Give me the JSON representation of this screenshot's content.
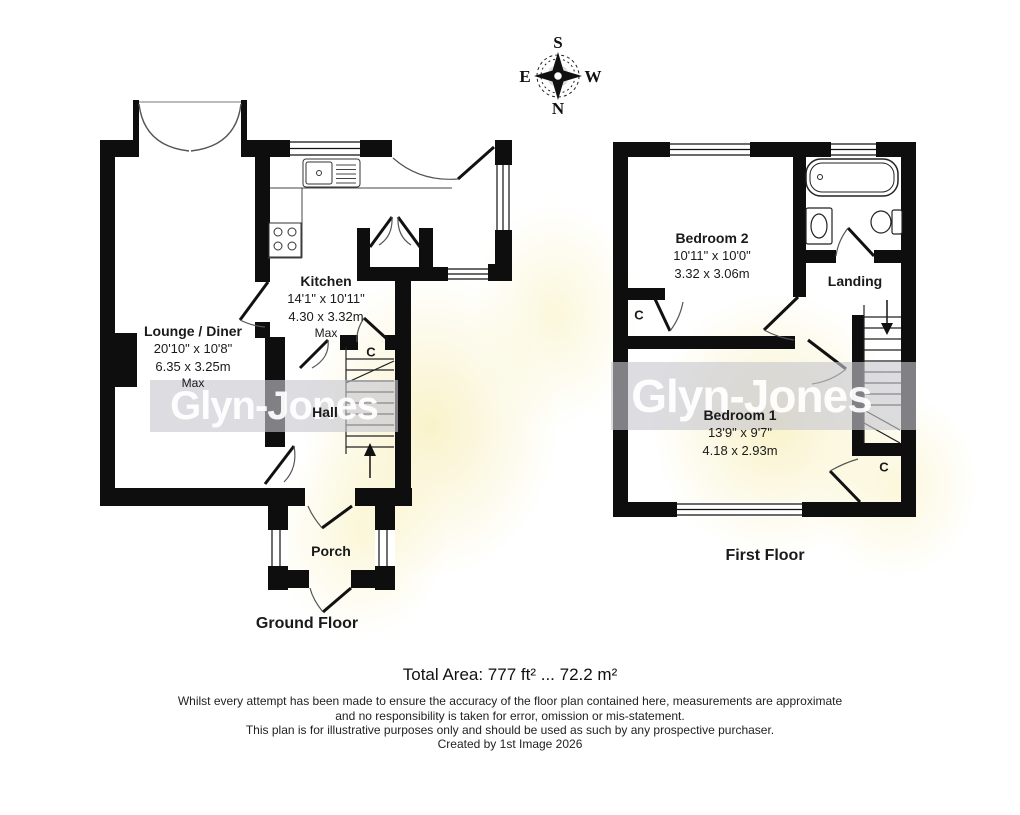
{
  "compass": {
    "top": "S",
    "left": "E",
    "right": "W",
    "bottom": "N"
  },
  "watermark": {
    "brand": "Glyn-Jones"
  },
  "ground_floor": {
    "title": "Ground Floor",
    "lounge": {
      "name": "Lounge / Diner",
      "imperial": "20'10\" x 10'8\"",
      "metric": "6.35 x 3.25m",
      "qualifier": "Max"
    },
    "kitchen": {
      "name": "Kitchen",
      "imperial": "14'1\" x 10'11\"",
      "metric": "4.30 x 3.32m",
      "qualifier": "Max"
    },
    "hall": {
      "name": "Hall"
    },
    "porch": {
      "name": "Porch"
    },
    "cupboard": "C"
  },
  "first_floor": {
    "title": "First Floor",
    "bedroom2": {
      "name": "Bedroom 2",
      "imperial": "10'11\" x 10'0\"",
      "metric": "3.32 x 3.06m"
    },
    "bedroom1": {
      "name": "Bedroom 1",
      "imperial": "13'9\" x 9'7\"",
      "metric": "4.18 x 2.93m"
    },
    "landing": {
      "name": "Landing"
    },
    "cupboard_left": "C",
    "cupboard_right": "C"
  },
  "footer": {
    "total_area": "Total Area: 777 ft² ... 72.2 m²",
    "disclaimer_1": "Whilst every attempt has been made to ensure the accuracy of the floor plan contained here, measurements are approximate",
    "disclaimer_2": "and no responsibility is taken for error, omission or mis-statement.",
    "disclaimer_3": "This plan is for illustrative purposes only and should be used as such by any prospective purchaser.",
    "credit": "Created by 1st Image 2026"
  },
  "colors": {
    "wall": "#0e0e0e",
    "band": "#c7c7ce",
    "flower": "#f3e696"
  }
}
